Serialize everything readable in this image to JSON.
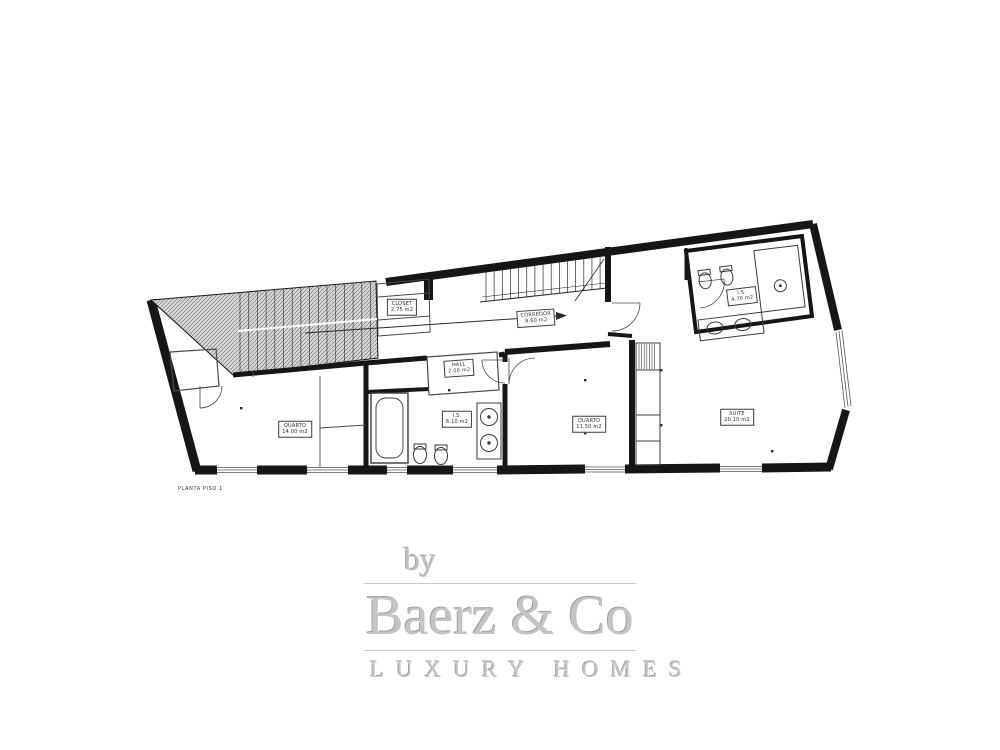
{
  "plan": {
    "title": "PLANTA PISO 1",
    "rooms": {
      "closet": {
        "name": "CLOSET",
        "area": "2.75 m2"
      },
      "corredor": {
        "name": "CORREDOR",
        "area": "8.60 m2"
      },
      "hall": {
        "name": "HALL",
        "area": "2.00 m2"
      },
      "wc1": {
        "name": "I.S.",
        "area": "6.10 m2"
      },
      "quarto1": {
        "name": "QUARTO",
        "area": "14.00 m2"
      },
      "quarto2": {
        "name": "QUARTO",
        "area": "11.50 m2"
      },
      "suite": {
        "name": "SUITE",
        "area": "20.10 m2"
      },
      "wc2": {
        "name": "I.S.",
        "area": "4.70 m2"
      }
    }
  },
  "branding": {
    "preposition": "by",
    "company": "Baerz & Co",
    "tagline": "LUXURY HOMES"
  },
  "colors": {
    "plan_line": "#161616",
    "hatch_fill": "#d8d8d8",
    "hatch_line": "#7e7e7e",
    "logo_gray": "#c4c4c4"
  }
}
